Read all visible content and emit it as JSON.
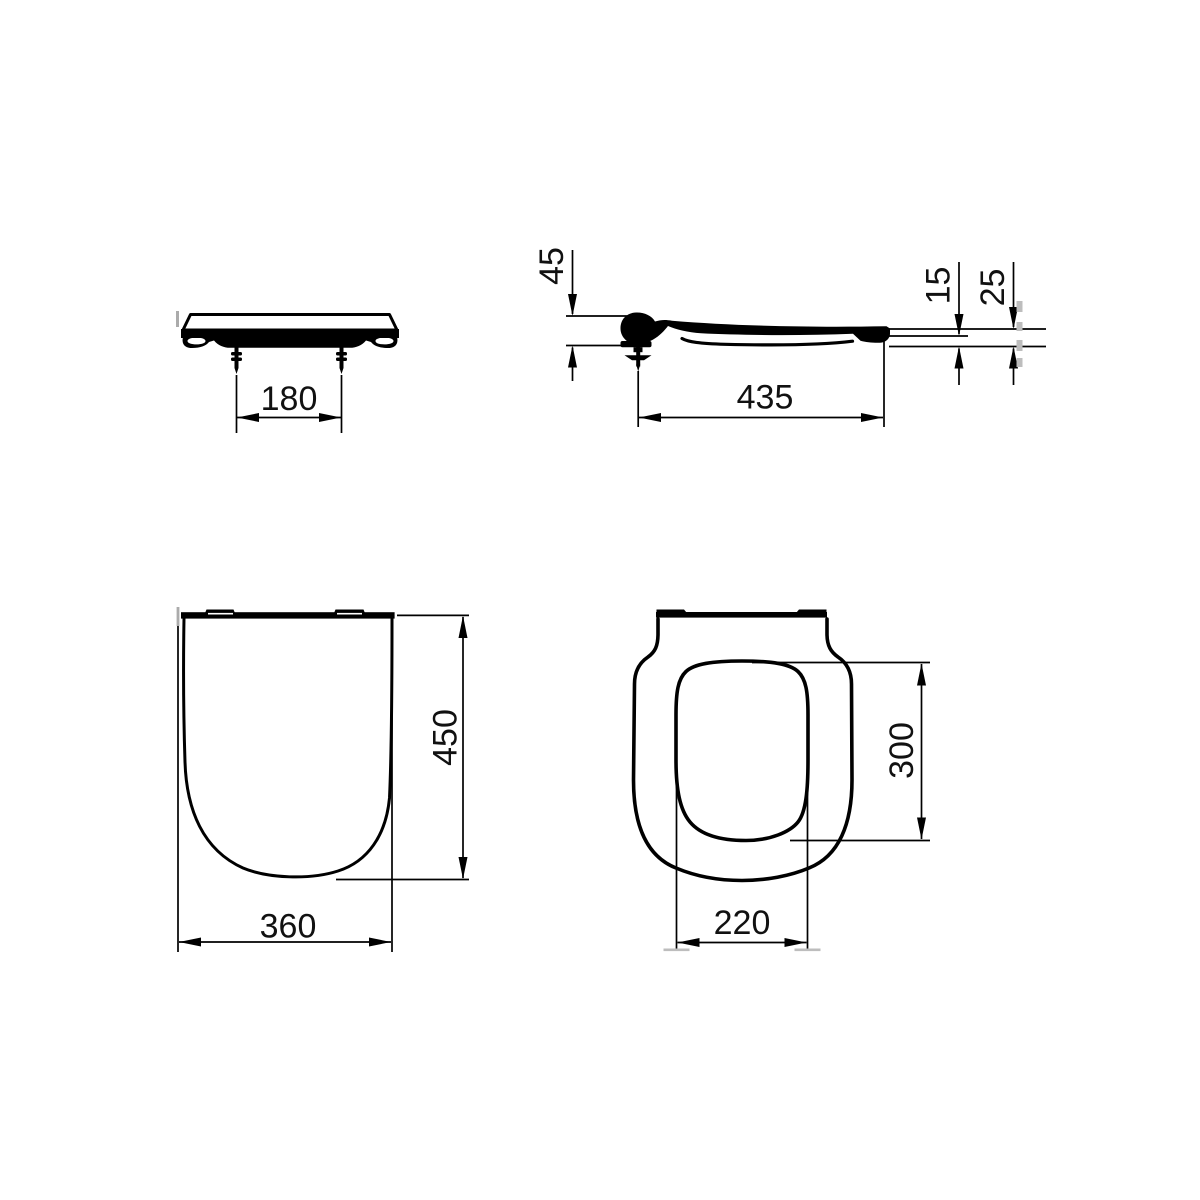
{
  "colors": {
    "background": "#ffffff",
    "line": "#000000",
    "text": "#111111",
    "scan_artifact_gray": "#ababab"
  },
  "views": {
    "front": {
      "name": "front elevation of seat",
      "dims": {
        "bolt_spacing": "180"
      }
    },
    "side": {
      "name": "side profile of seat",
      "dims": {
        "hinge_height": "45",
        "seat_depth": "435",
        "front_edge_thickness": "15",
        "front_edge_total_height": "25"
      }
    },
    "top_cover": {
      "name": "plan view of closed cover",
      "dims": {
        "overall_length": "450",
        "overall_width": "360"
      }
    },
    "top_ring": {
      "name": "plan view of seat ring",
      "dims": {
        "opening_length": "300",
        "opening_width": "220"
      }
    }
  }
}
